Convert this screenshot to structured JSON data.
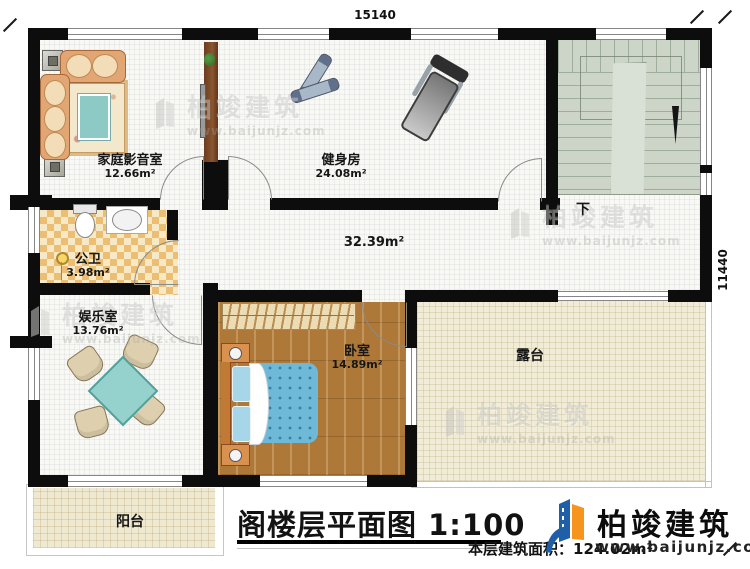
{
  "plan": {
    "title": "阁楼层平面图",
    "scale": "1:100",
    "floor_area_label": "本层建筑面积：",
    "floor_area_value": "124.02m²",
    "dim_top": "15140",
    "dim_right": "11440",
    "hall_area": "32.39m²",
    "stairs_down": "下"
  },
  "rooms": {
    "home_theater": {
      "name": "家庭影音室",
      "area": "12.66m²"
    },
    "gym": {
      "name": "健身房",
      "area": "24.08m²"
    },
    "bathroom": {
      "name": "公卫",
      "area": "3.98m²"
    },
    "entertainment": {
      "name": "娱乐室",
      "area": "13.76m²"
    },
    "bedroom": {
      "name": "卧室",
      "area": "14.89m²"
    },
    "terrace": {
      "name": "露台"
    },
    "balcony": {
      "name": "阳台"
    }
  },
  "brand": {
    "name": "柏竣建筑",
    "website": "www.baijunjz.com"
  },
  "watermark": {
    "name": "柏竣建筑",
    "website": "www.baijunjz.com"
  },
  "colors": {
    "wall": "#0d0d0d",
    "logo_blue": "#1f5fa8",
    "logo_orange": "#f7941d",
    "stairs": "#ccd5c8",
    "terrace": "#f1ecd8"
  }
}
